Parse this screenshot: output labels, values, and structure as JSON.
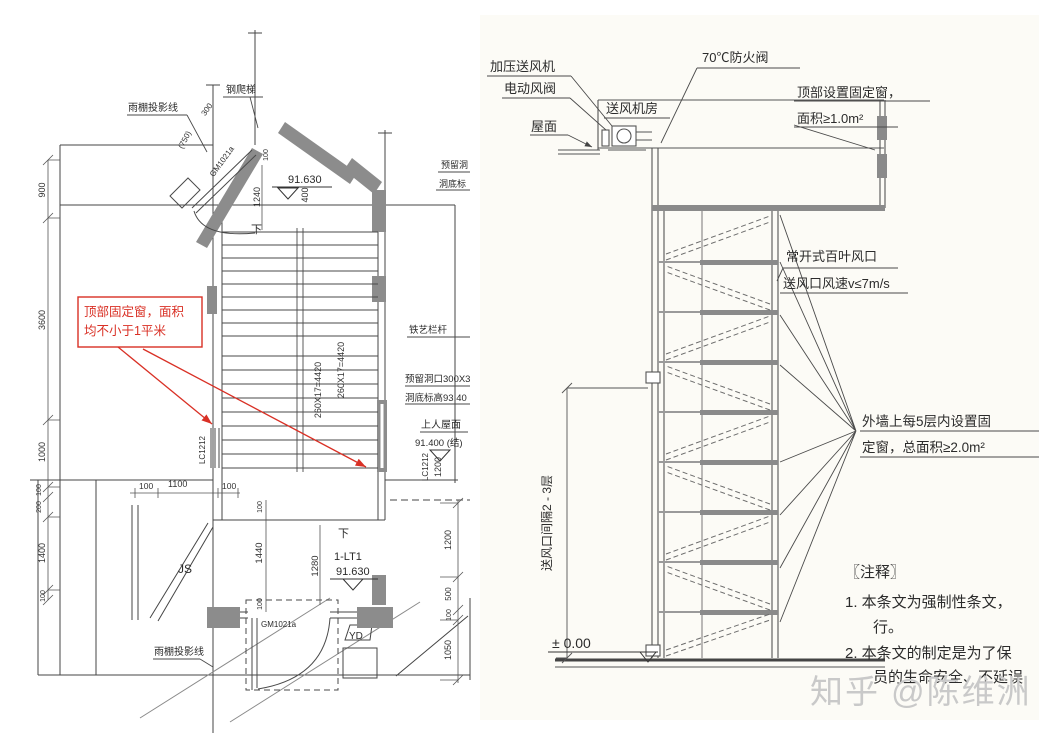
{
  "watermark": {
    "text": "知乎 @陈维洲",
    "color": "#c9c9c9"
  },
  "plan": {
    "red_note": {
      "line1": "顶部固定窗，面积",
      "line2": "均不小于1平米",
      "color": "#d93025"
    },
    "labels": {
      "canopy_top": "雨棚投影线",
      "canopy_bottom": "雨棚投影线",
      "steel_ladder": "钢爬梯",
      "door_top": "GM1021a",
      "door_bottom": "GM1021a",
      "window_left": "LC1212",
      "window_right": "LC1212",
      "room_js": "JS",
      "room_yd": "YD",
      "stair_name": "1-LT1",
      "down_top": "下",
      "down_bottom": "下",
      "level_top": "91.630",
      "level_bottom": "91.630",
      "roof_access": "上人屋面",
      "roof_level": "91.400 (结)",
      "iron_railing": "铁艺栏杆",
      "reserved_hole_top": "预留洞",
      "hole_level_top": "洞底标",
      "reserved_hole": "预留洞口300X3",
      "hole_level": "洞底标高93.40",
      "flight_left": "260X17=4420",
      "flight_right": "260X17=4420"
    },
    "dims": {
      "left_900": "900",
      "left_3600": "3600",
      "left_1000": "1000",
      "left_100a": "100",
      "left_200": "200",
      "left_1400": "1400",
      "left_100b": "100",
      "top_100": "100",
      "d1240": "1240",
      "d400": "400",
      "d300": "300",
      "d750": "(750)",
      "bottom_100a": "100",
      "bottom_1100": "1100",
      "bottom_100b": "100",
      "mid_100a": "100",
      "mid_1440": "1440",
      "mid_100b": "100",
      "mid_1280": "1280",
      "right_1200": "1200",
      "right_500": "500",
      "right_100": "100",
      "right_1050": "1050",
      "win_1200": "1200"
    }
  },
  "section": {
    "labels": {
      "fan": "加压送风机",
      "valve": "电动风阀",
      "fan_room": "送风机房",
      "roof": "屋面",
      "fire_damper": "70℃防火阀",
      "top_window_1": "顶部设置固定窗，",
      "top_window_2": "面积≥1.0m²",
      "louver_1": "常开式百叶风口",
      "louver_2": "送风口风速v≤7m/s",
      "wall_window_1": "外墙上每5层内设置固",
      "wall_window_2": "定窗，总面积≥2.0m²",
      "spacing": "送风口间隔2 - 3层",
      "ground": "± 0.00"
    },
    "notes": {
      "title": "〖注释〗",
      "n1a": "1.  本条文为强制性条文，",
      "n1b": "行。",
      "n2a": "2.  本条文的制定是为了保",
      "n2b": "员的生命安全、不延误"
    }
  }
}
